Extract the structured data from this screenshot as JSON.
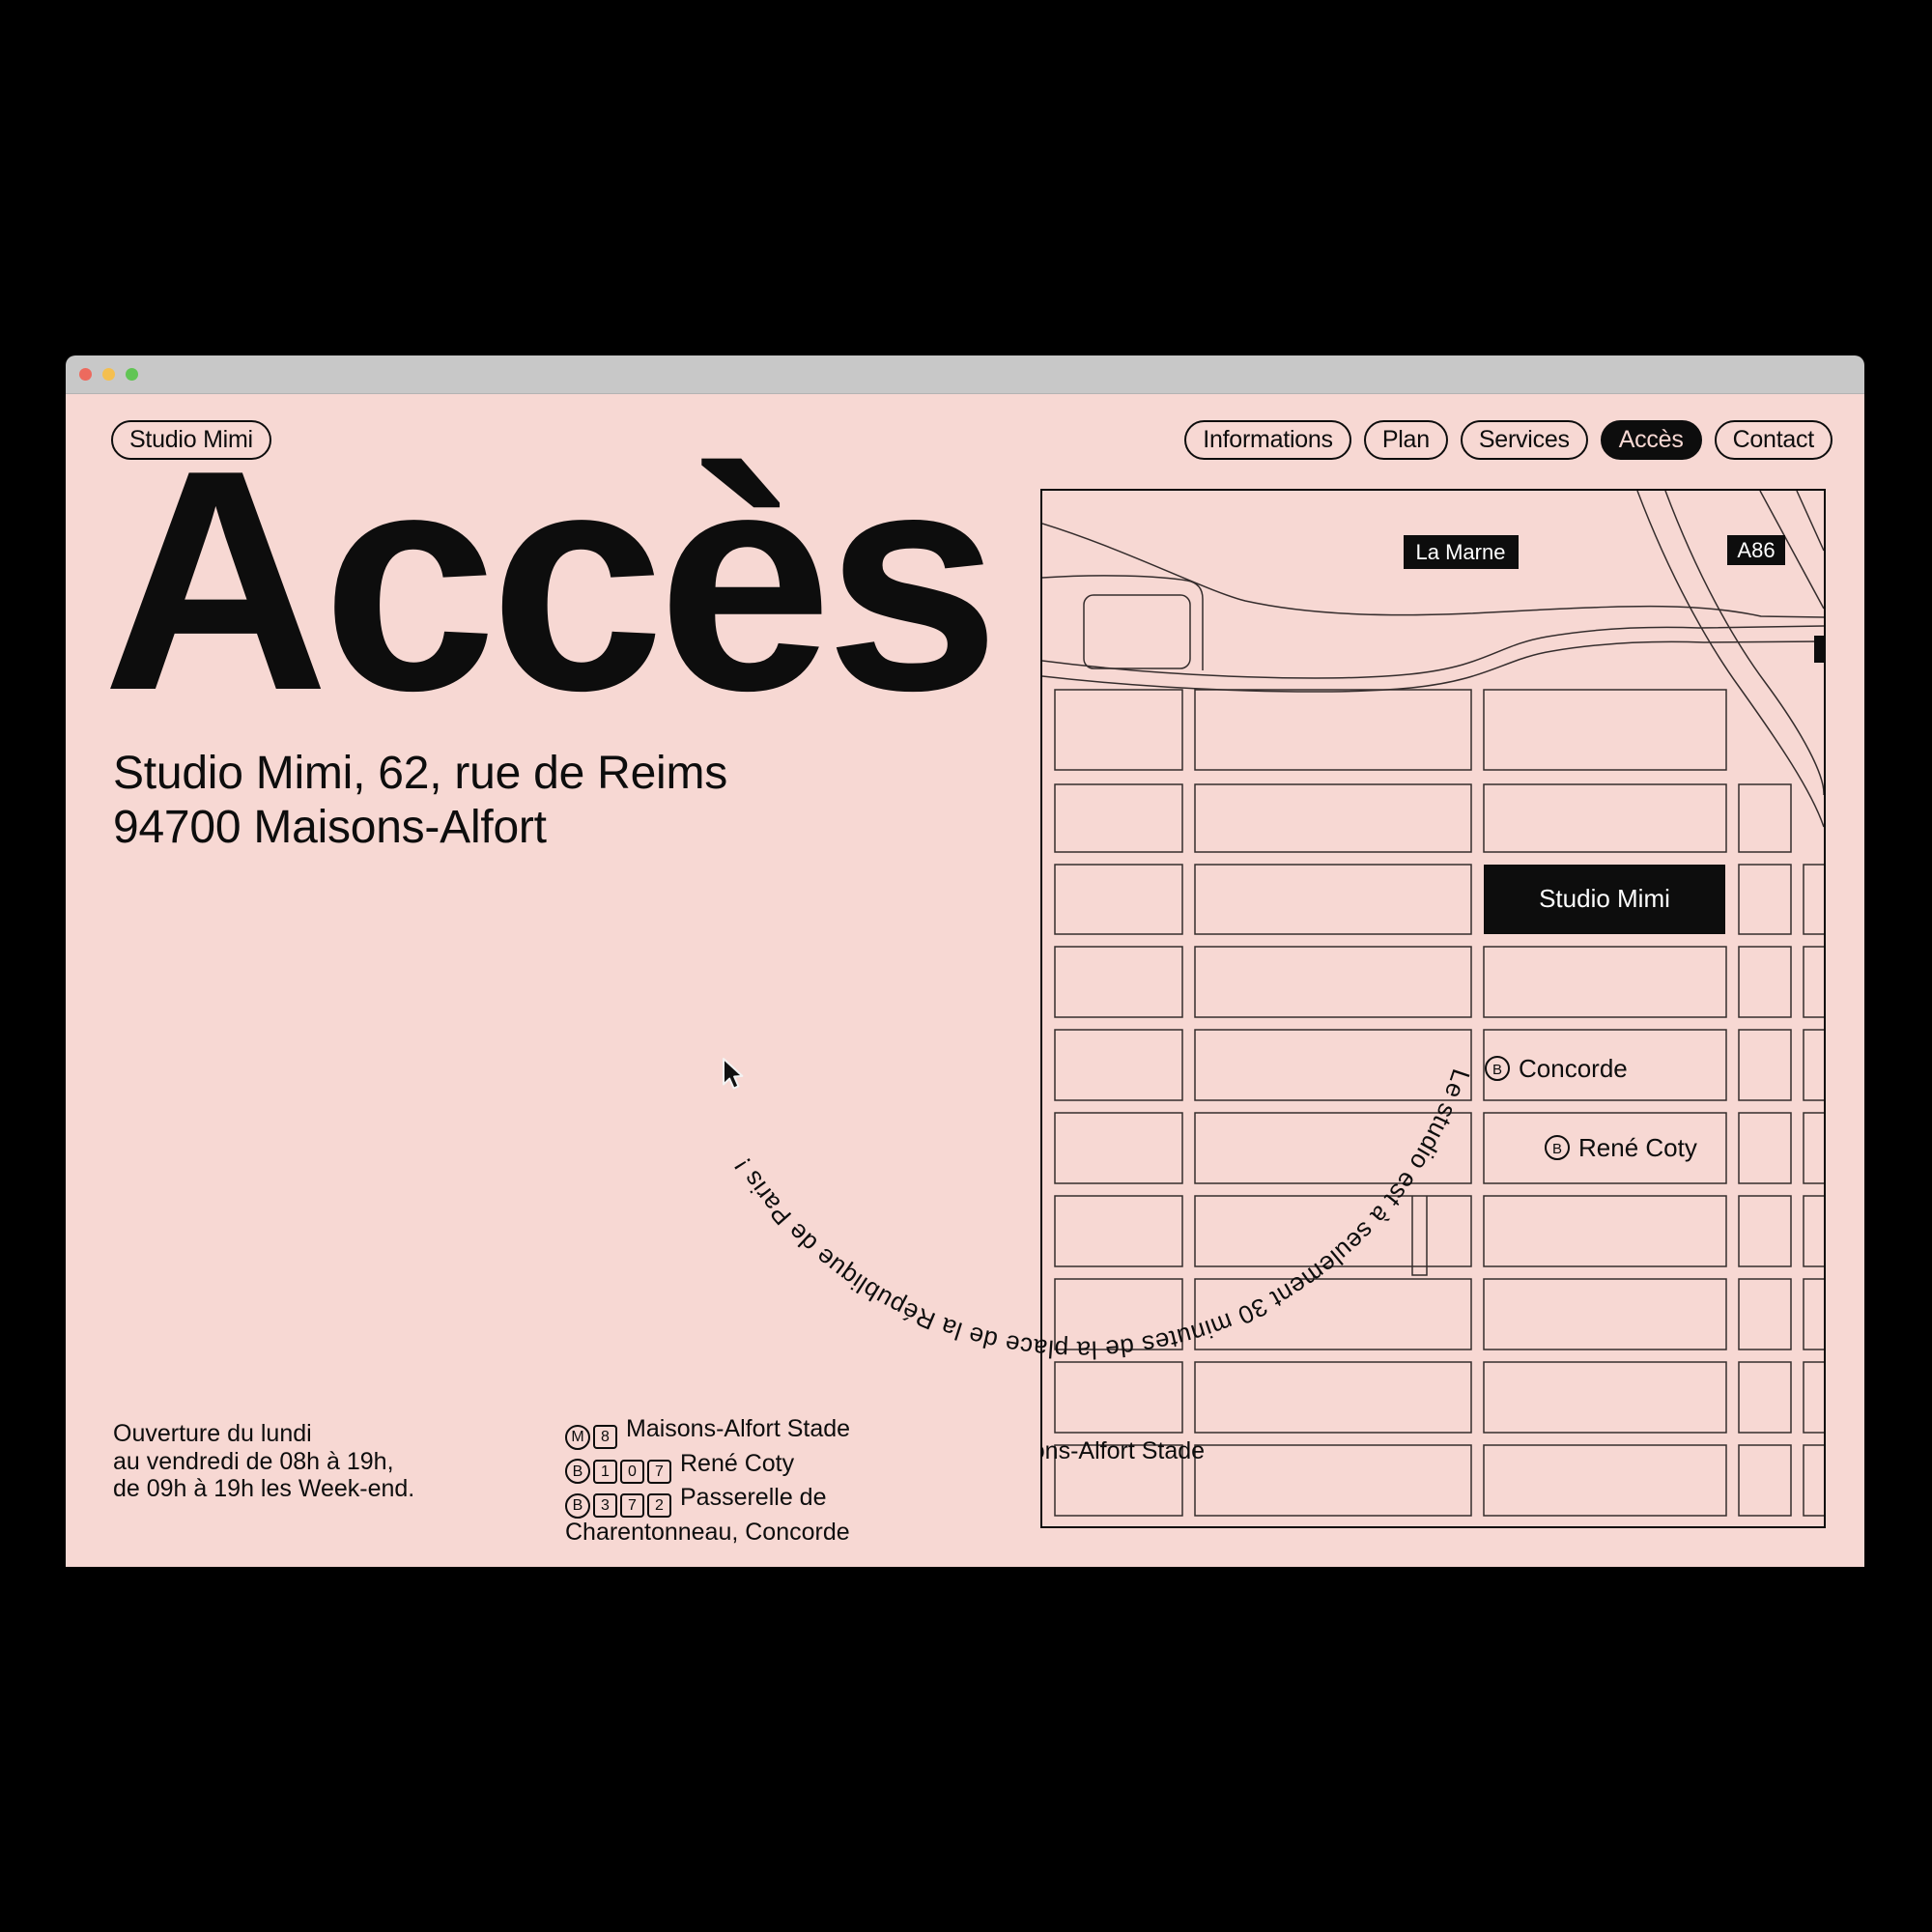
{
  "colors": {
    "canvas": "#000000",
    "titlebar": "#c8c8c8",
    "page-bg": "#f7d8d3",
    "ink": "#0d0d0d",
    "map-line": "#352d2d",
    "traffic-red": "#ed6a5e",
    "traffic-yellow": "#f4bf4f",
    "traffic-green": "#61c554",
    "label-text": "#ffffff"
  },
  "brand": {
    "label": "Studio Mimi"
  },
  "nav": {
    "items": [
      {
        "label": "Informations",
        "active": false
      },
      {
        "label": "Plan",
        "active": false
      },
      {
        "label": "Services",
        "active": false
      },
      {
        "label": "Accès",
        "active": true
      },
      {
        "label": "Contact",
        "active": false
      }
    ]
  },
  "hero": {
    "title": "Accès",
    "address_line1": "Studio Mimi, 62, rue de Reims",
    "address_line2": "94700 Maisons-Alfort"
  },
  "hours": {
    "lines": [
      "Ouverture du lundi",
      "au vendredi de 08h à 19h,",
      "de 09h à 19h les Week-end."
    ]
  },
  "transit": {
    "lines": [
      {
        "icons": [
          {
            "shape": "circle",
            "label": "M"
          },
          {
            "shape": "square",
            "label": "8"
          }
        ],
        "text": "Maisons-Alfort Stade"
      },
      {
        "icons": [
          {
            "shape": "circle",
            "label": "B"
          },
          {
            "shape": "square",
            "label": "1"
          },
          {
            "shape": "square",
            "label": "0"
          },
          {
            "shape": "square",
            "label": "7"
          }
        ],
        "text": "René Coty"
      },
      {
        "icons": [
          {
            "shape": "circle",
            "label": "B"
          },
          {
            "shape": "square",
            "label": "3"
          },
          {
            "shape": "square",
            "label": "7"
          },
          {
            "shape": "square",
            "label": "2"
          }
        ],
        "text": "Passerelle de Charentonneau, Concorde"
      }
    ]
  },
  "map": {
    "river_label": "La Marne",
    "motorway_label": "A86",
    "studio_label": "Studio Mimi",
    "station1_icon": "B",
    "station1_name": "Concorde",
    "station2_icon": "B",
    "station2_name": "René Coty",
    "stade_label": "Maisons-Alfort Stade"
  },
  "curved_text": "Le studio est à seulement 30 minutes de la place de la République de Paris !"
}
